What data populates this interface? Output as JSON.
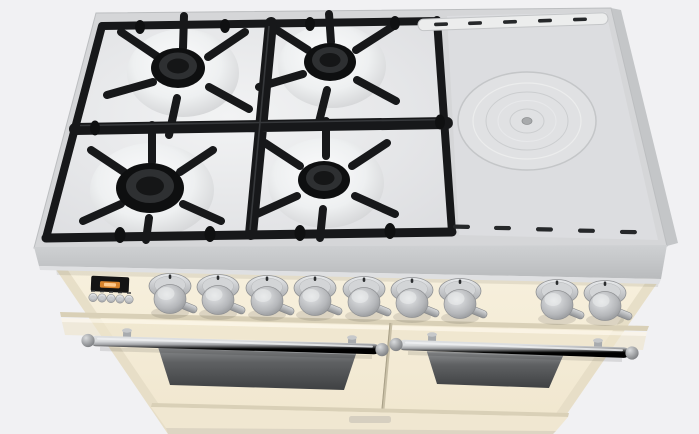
{
  "scene": {
    "type": "3d-product-render",
    "description": "Top-front view render of a freestanding cream range cooker: four-burner gas hob with black cast-iron grates on the left, solid steel griddle plate with concentric rings on the right, vent slots, nine chrome control knobs, a small dark display with amber glow and five round buttons, and two oven doors with chrome rail handles and dark glass windows.",
    "background_color": "#f1f1f3"
  },
  "colors": {
    "cooktop_steel": "#d5d6d8",
    "cooktop_side": "#c4c6c8",
    "hob_bed": "#e9eaec",
    "grate_black": "#17181a",
    "burner_cap": "#0e0f10",
    "plate_steel": "#dcdde0",
    "vent_slot": "#26282a",
    "body_cream": "#f5edd8",
    "crease_shadow": "#d9d0b7",
    "knob_metal": "#c9cbcd",
    "display_bg": "#141414",
    "display_glow": "#e2892d",
    "handle_metal": "#9a9da0",
    "oven_window_dark": "#46484a",
    "badge_plate": "#cfc9bb"
  },
  "cooktop": {
    "burners": [
      {
        "position": "rear-left",
        "size": "medium"
      },
      {
        "position": "rear-right",
        "size": "medium"
      },
      {
        "position": "front-left",
        "size": "large"
      },
      {
        "position": "front-right",
        "size": "medium"
      }
    ],
    "griddle_plate": {
      "rings": 5,
      "center_cap": true
    },
    "top_vent_slots": 5,
    "front_vent_slots": 5
  },
  "control_panel": {
    "display": {
      "glow_color": "#e2892d",
      "text_legible": false
    },
    "buttons": 5,
    "knobs": {
      "left_group": 7,
      "right_group": 2,
      "total": 9
    }
  },
  "ovens": {
    "doors": 2,
    "handle_style": "chrome rail with ball finials",
    "windows": 2
  },
  "branding": {
    "badge_visible": true,
    "badge_text_legible": false
  }
}
